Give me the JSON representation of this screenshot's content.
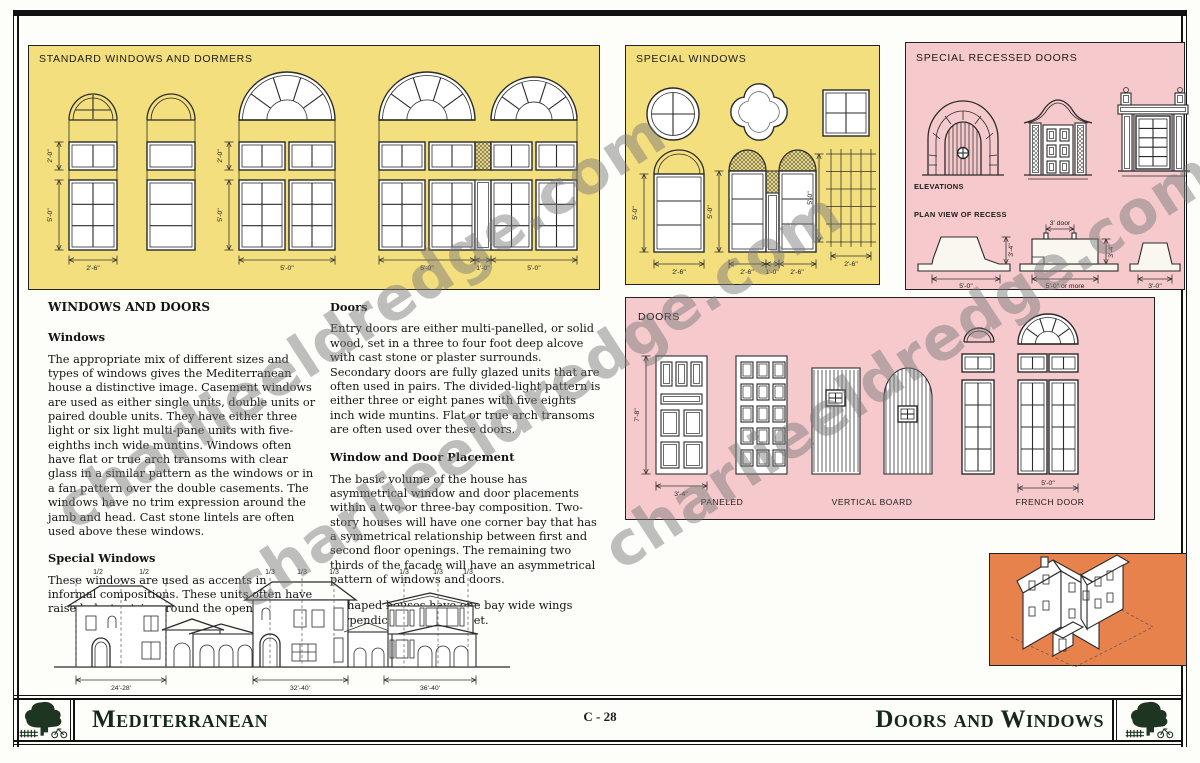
{
  "page": {
    "series_label": "Mediterranean",
    "page_number": "C - 28",
    "page_title": "Doors and Windows",
    "watermark_text": "charlieeldredge.com"
  },
  "colors": {
    "panel_yellow": "#F3DF7D",
    "panel_pink": "#F6C9CD",
    "panel_orange": "#E8824D",
    "footer_green": "#16281b"
  },
  "standard_panel": {
    "title": "STANDARD WINDOWS AND DORMERS",
    "dim_transom_height": "2'-0\"",
    "dim_casement_height": "5'-0\"",
    "dim_width_small": "2'-6\"",
    "dim_width_large": "5'-0\"",
    "dim_width_center": "1'-0\""
  },
  "special_panel": {
    "title": "SPECIAL WINDOWS",
    "dim_height": "5'-0\"",
    "dim_width": "2'-6\"",
    "dim_center": "1'-0\""
  },
  "recessed_panel": {
    "title": "SPECIAL RECESSED DOORS",
    "elevations_label": "ELEVATIONS",
    "plan_label": "PLAN VIEW OF RECESS",
    "dim_depth": "3'-4\"",
    "dim_door": "3' door",
    "dim_plan1": "5'-0\"",
    "dim_plan2": "5'-0\" or more",
    "dim_plan3": "3'-0\""
  },
  "doors_panel": {
    "title": "DOORS",
    "dim_height": "7'-8\"",
    "dim_width": "3'-4\"",
    "dim_french": "5'-0\"",
    "label_paneled": "PANELED",
    "label_vertical": "VERTICAL BOARD",
    "label_french": "FRENCH DOOR"
  },
  "article": {
    "heading": "WINDOWS AND DOORS",
    "windows_heading": "Windows",
    "windows_body": "The appropriate mix of different sizes and types of windows gives the Mediterranean house a distinctive image. Casement windows are used as either single units, double units or paired double units. They have either three light or six light multi-pane units with five-eighths inch wide muntins. Windows often have flat or true arch transoms with clear glass in a similar pattern as the windows or in a fan pattern over the double casements. The windows have no trim expression around the jamb and head. Cast stone lintels are often used above these windows.",
    "special_heading": "Special Windows",
    "special_body": "These windows are used as accents in informal compositions. These units often have raised plaster trim around the openings.",
    "doors_heading": "Doors",
    "doors_body": "Entry doors are either multi-panelled, or solid wood, set in a three to four foot deep alcove with cast stone or plaster surrounds. Secondary doors are fully glazed units that are often used in pairs. The divided-light pattern is either three or eight panes with five eights inch wide muntins. Flat or true arch transoms are often used over these doors.",
    "placement_heading": "Window and Door Placement",
    "placement_body": "The basic volume of the house has asymmetrical window and door placements within a two-or three-bay composition. Two-story houses will have one corner bay that has a symmetrical relationship between first and second floor openings. The remaining two thirds of the facade will have an asymmetrical pattern of windows and doors.",
    "placement_body2": "L-shaped houses have one bay wide wings perpendicular to the street."
  },
  "elevations": {
    "houses": [
      {
        "fractions": [
          "1/2",
          "1/2"
        ],
        "width": "24'-28'"
      },
      {
        "fractions": [
          "1/3",
          "1/3",
          "1/3"
        ],
        "width": "32'-40'"
      },
      {
        "fractions": [
          "1/3",
          "1/3",
          "1/3"
        ],
        "width": "36'-40'"
      }
    ]
  }
}
